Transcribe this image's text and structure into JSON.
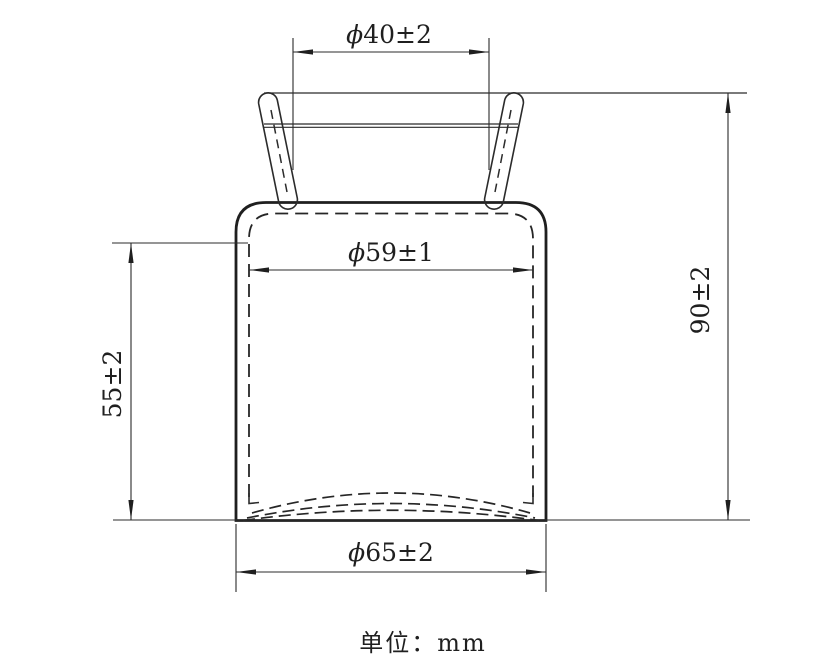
{
  "drawing": {
    "description": "Technical drawing of a jar / bottle liner with everted rim, front section view",
    "unit_label": "单位：mm",
    "colors": {
      "line": "#1f1f1f",
      "background": "#ffffff"
    },
    "dimensions": {
      "mouth_diameter": {
        "phi": "ϕ",
        "value": "40±2",
        "full": "ϕ40±2",
        "orientation": "horizontal",
        "location": "top mouth opening"
      },
      "inner_diameter": {
        "phi": "ϕ",
        "value": "59±1",
        "full": "ϕ59±1",
        "orientation": "horizontal",
        "location": "inner body wall"
      },
      "bottom_diameter": {
        "phi": "ϕ",
        "value": "65±2",
        "full": "ϕ65±2",
        "orientation": "horizontal",
        "location": "outer body at bottom"
      },
      "body_height": {
        "value": "55±2",
        "full": "55±2",
        "orientation": "vertical",
        "location": "left, straight body section"
      },
      "overall_height": {
        "value": "90±2",
        "full": "90±2",
        "orientation": "vertical",
        "location": "right, rim to bottom"
      }
    }
  }
}
